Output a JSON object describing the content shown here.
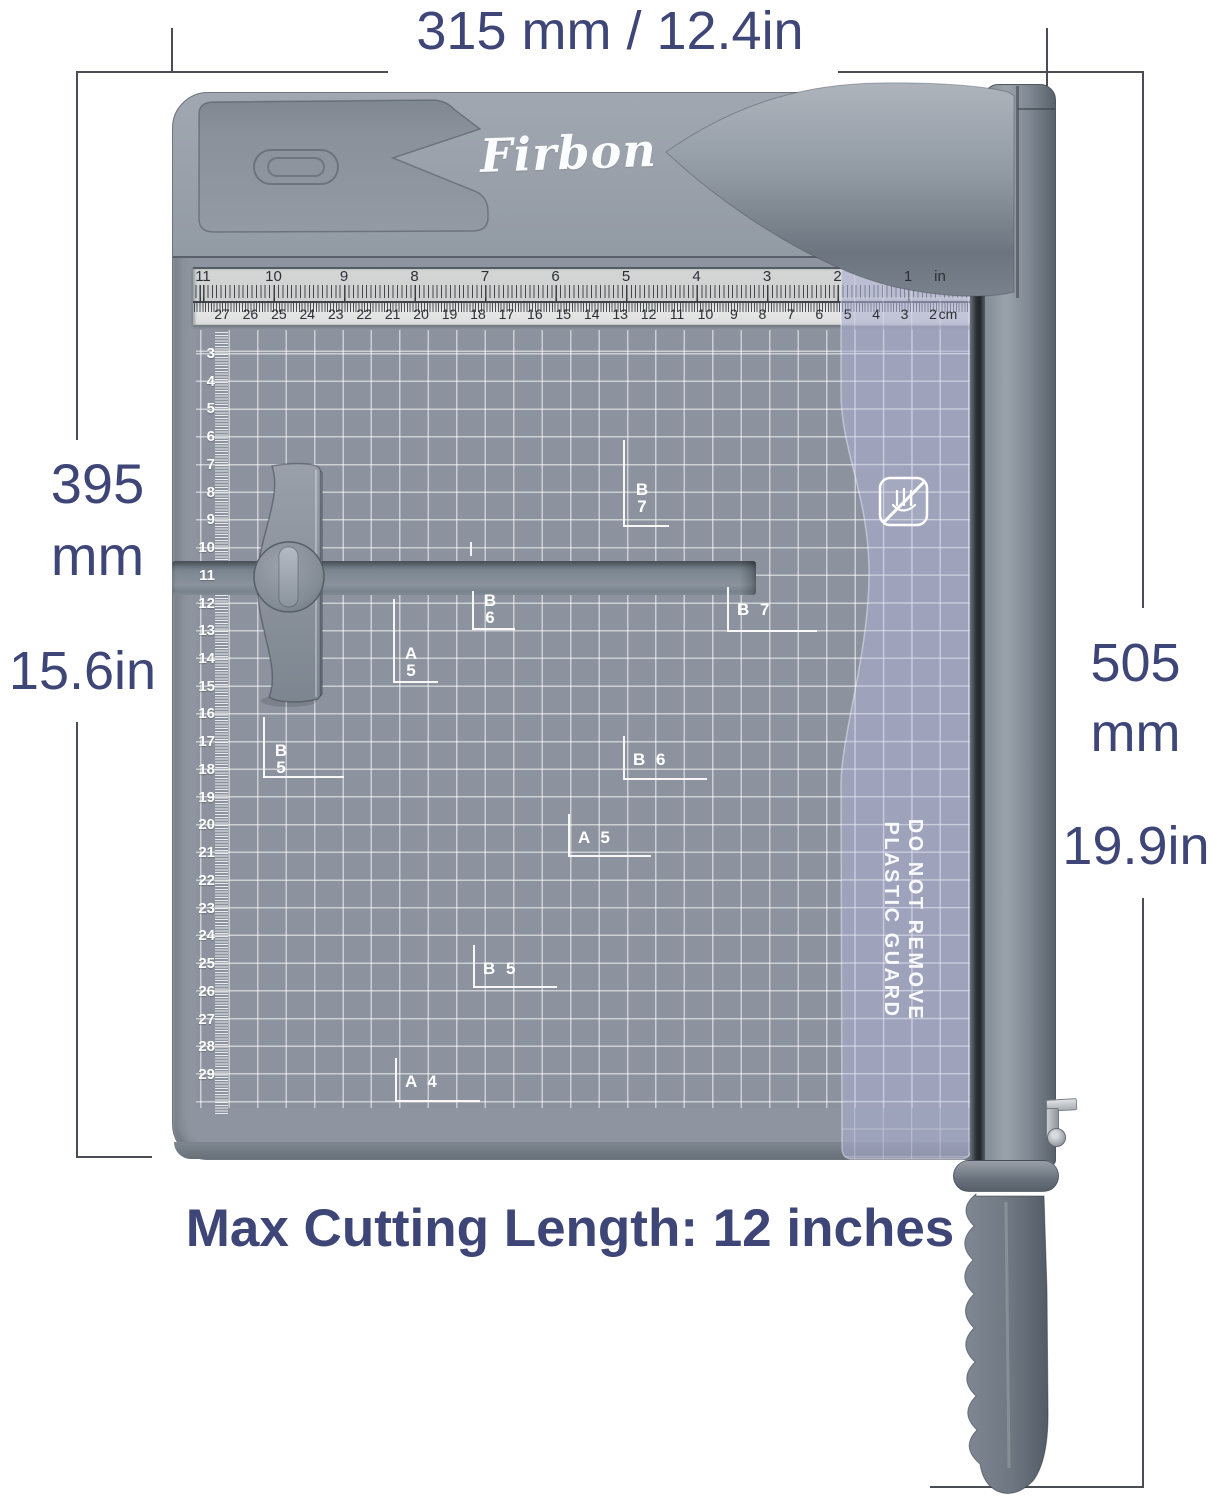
{
  "colors": {
    "accent": "#3E4577",
    "dim_line": "#4A4E54",
    "board_gray": "#99A0A9",
    "mat_gray": "#8C939E",
    "guard_lavender": "#AAAED0",
    "metal_gray": "#7E8791",
    "grid_line": "#FFFFFF",
    "ruler_bg": "#D5D7D6"
  },
  "annotations": {
    "top_width": "315 mm / 12.4in",
    "left_mm": [
      "395",
      "mm"
    ],
    "left_in": "15.6in",
    "right_mm": [
      "505",
      "mm"
    ],
    "right_in": "19.9in",
    "caption": "Max Cutting Length: 12 inches"
  },
  "product": {
    "brand": "Firbon",
    "guard_warning": [
      "DO NOT REMOVE",
      "PLASTIC GUARD"
    ]
  },
  "rulers": {
    "top_inches": [
      "11",
      "10",
      "9",
      "8",
      "7",
      "6",
      "5",
      "4",
      "3",
      "2",
      "1"
    ],
    "top_inches_unit": "in",
    "top_cm": [
      "27",
      "26",
      "25",
      "24",
      "23",
      "22",
      "21",
      "20",
      "19",
      "18",
      "17",
      "16",
      "15",
      "14",
      "13",
      "12",
      "11",
      "10",
      "9",
      "8",
      "7",
      "6",
      "5",
      "4",
      "3",
      "2"
    ],
    "top_cm_unit": "cm",
    "side_cm": [
      "3",
      "4",
      "5",
      "6",
      "7",
      "8",
      "9",
      "10",
      "11",
      "12",
      "13",
      "14",
      "15",
      "16",
      "17",
      "18",
      "19",
      "20",
      "21",
      "22",
      "23",
      "24",
      "25",
      "26",
      "27",
      "28",
      "29"
    ]
  },
  "paper_marks": [
    {
      "id": "b7-stacked",
      "lines": [
        "B",
        "7"
      ]
    },
    {
      "id": "b6-stacked",
      "lines": [
        "B",
        "6"
      ]
    },
    {
      "id": "a5-stacked",
      "lines": [
        "A",
        "5"
      ]
    },
    {
      "id": "b5-stacked",
      "lines": [
        "B",
        "5"
      ]
    },
    {
      "id": "b7-right",
      "lines": [
        "B 7"
      ]
    },
    {
      "id": "b6-mid",
      "lines": [
        "B 6"
      ]
    },
    {
      "id": "a5-mid",
      "lines": [
        "A 5"
      ]
    },
    {
      "id": "b5-mid",
      "lines": [
        "B 5"
      ]
    },
    {
      "id": "a4-mid",
      "lines": [
        "A 4"
      ]
    }
  ]
}
